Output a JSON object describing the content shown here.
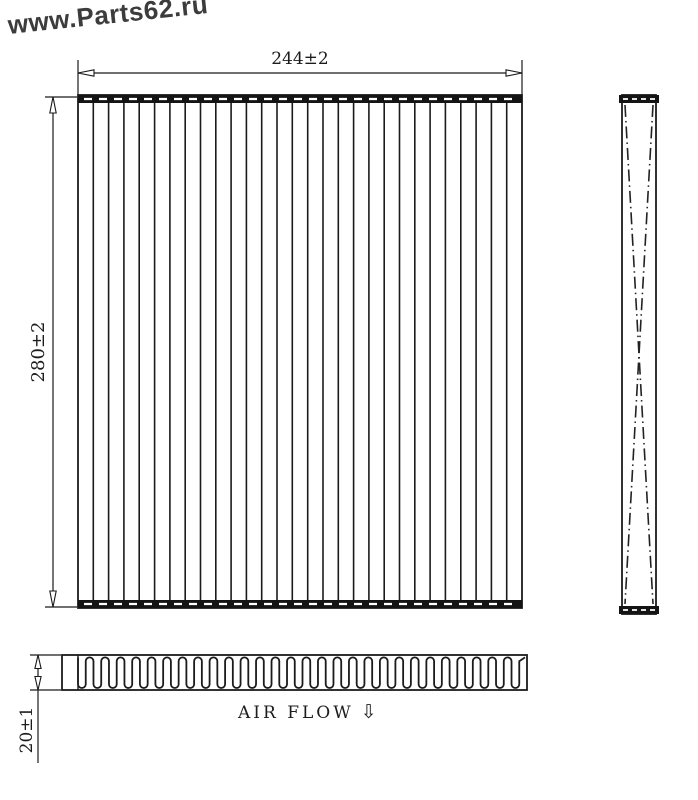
{
  "watermark": {
    "text": "www.Parts62.ru",
    "color": "#3c3c3c"
  },
  "dimensions": {
    "width_label": "244±2",
    "height_label": "280±2",
    "depth_label": "20±1"
  },
  "air_flow": {
    "label": "AIR FLOW",
    "arrow": "⇩"
  },
  "diagram": {
    "type": "cabin-air-filter-technical-drawing",
    "line_color": "#1b1b1b",
    "front_pleat_line_count": 28,
    "bottom_pleat_count": 29
  }
}
